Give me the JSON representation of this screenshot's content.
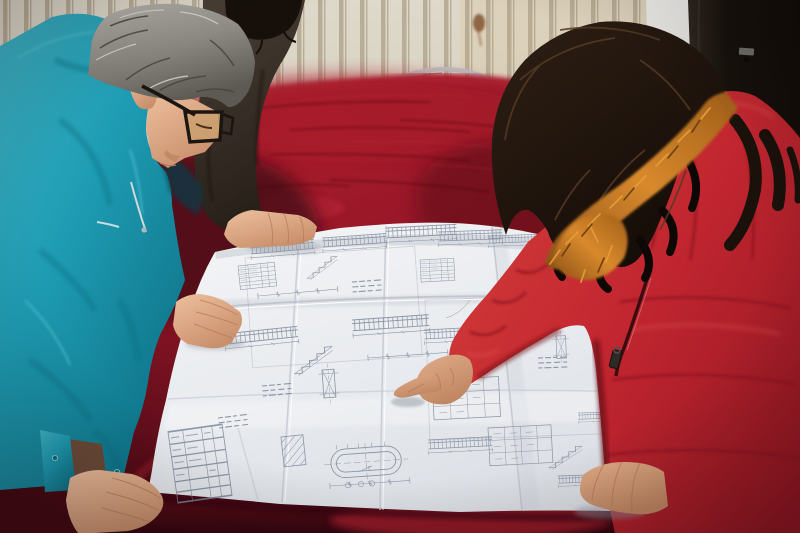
{
  "scene": {
    "title": "Workers reviewing construction blueprints on a velvet-covered table",
    "description": "Two colleagues lean over a large folded engineering blueprint spread on a dark red velvet covered table. A gray-haired man in a teal work jacket and black glasses studies the sheet; a woman in a red down coat with an orange fur-trimmed hood points at a detail with her index finger; a third person in a dark jacket rests a hand on the drawings. Behind them is a cream slatted radiator wall, a red-seat metal chair and a dark door panel.",
    "objects": {
      "blueprint": "Large folded white engineering drawing sheet with dense structural line work",
      "table": "Table draped in dark red velvet cloth",
      "chair": "Chair with red seat and silver metal frame behind the table",
      "wall": "Cream slatted radiator wall with rust stain",
      "door": "Dark door panel at right with small metal latch"
    },
    "people": {
      "man": "Middle-aged man, gray hair, black eyeglasses, teal work jacket, both hands on the drawing",
      "woman": "Woman with long dark wavy hair, red down coat, orange fur hood trim, pointing at the blueprint",
      "third": "Partially visible person in a dark jacket with one hand resting on the sheet"
    }
  },
  "palette": {
    "wall": "#d7d0c0",
    "wall_slat": "#b2a68e",
    "wall_warm": "#dbc9a4",
    "rust": "#7c4a24",
    "door_frame": "#f2f1ee",
    "door_frame_dark": "#c2c0ba",
    "door": "#17110c",
    "door_edge": "#2f2720",
    "latch": "#6f6e68",
    "chair_seat": "#a2212a",
    "chair_frame": "#bcc0c3",
    "velvet": "#6d1020",
    "velvet_bright": "#a81c2c",
    "velvet_mid": "#8c1425",
    "velvet_dark": "#440913",
    "velvet_front": "#7c1322",
    "paper": "#f3f4f6",
    "paper_shade": "#dcdfe5",
    "ink": "#7d8798",
    "teal": "#1e9cb3",
    "teal_light": "#3fb4c6",
    "teal_dark": "#0d7085",
    "hair_gray_light": "#bdbab2",
    "hair_gray_dark": "#5d5a54",
    "skin": "#eec09e",
    "skin_shadow": "#c98f6b",
    "jacket_third": "#4a4036",
    "jacket_third_dark": "#272019",
    "hair_black": "#17100a",
    "hair_woman": "#140c07",
    "hair_sheen": "#553a24",
    "fur": "#d8892c",
    "fur_dark": "#8a5016",
    "fur_light": "#e79d3c",
    "coat": "#c22630",
    "coat_light": "#d03a38",
    "coat_dark": "#941722",
    "coat_deep": "#5f0d14",
    "skin_woman": "#e2ad89",
    "skin_woman_shadow": "#c08662",
    "glasses": "#1a1510",
    "zipper": "#3b0c10"
  }
}
